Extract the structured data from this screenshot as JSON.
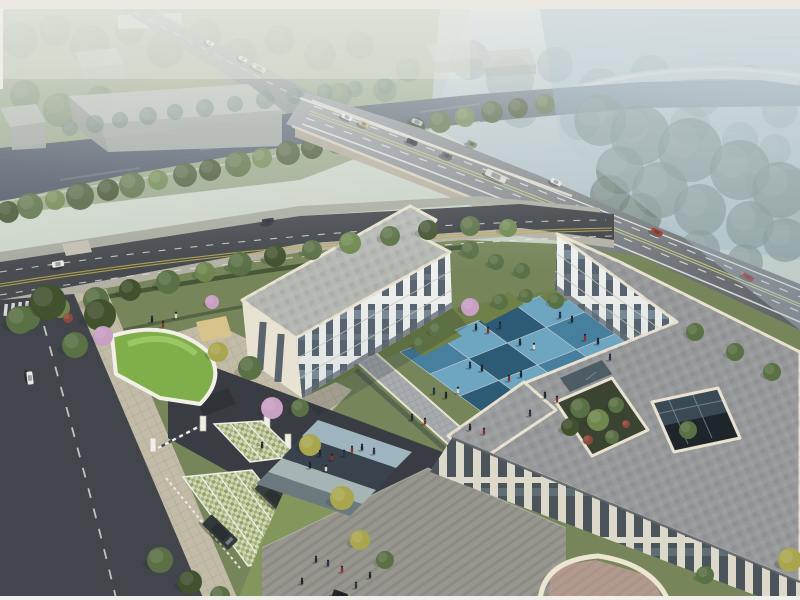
{
  "scene": {
    "type": "aerial-architectural-rendering"
  },
  "palette": {
    "river": "#51596a",
    "road_dark": "#42454b",
    "drive_dark": "#393c42",
    "ave_gray": "#8f9398",
    "lane_white": "#e9eae6",
    "lane_yellow": "#c2cc85",
    "bridge_fascia": "#b4ad9c",
    "parapet": "#e9e2d0",
    "facade_lit": "#edefec",
    "facade_warm": "#e7e2d1",
    "facade_shade": "#d8d4c5",
    "window_glass": "#3f4d5a",
    "roof_gray": "#97999b",
    "roof_left": "#b6b8b4",
    "court_light": "#6ea6c2",
    "court_mid": "#47809e",
    "court_dark": "#2d5a74",
    "grass_base": "#76865a",
    "grass_bright": "#83975c",
    "grass_court": "#6f8148",
    "green_roof": "#7fae4a",
    "stall": "#d2d6b8",
    "paver": "#c2bba7",
    "plaza": "#98978f",
    "terrace_pink": "#b29a8e",
    "warehouse_top": "#bcbfba",
    "warehouse_side": "#a7aba6",
    "sand": "#d8c38a",
    "band_light": "#9eb5bf",
    "band_dark": "#39434e",
    "band_pale": "#a7b4b4",
    "band_mid": "#6c7a80"
  },
  "courtyard": {
    "origin": [
      400,
      352
    ],
    "a": [
      38.75,
      -15.5
    ],
    "b": [
      30,
      22
    ],
    "rows": 4,
    "cols": 4,
    "tiles": [
      [
        "m",
        "l",
        "d",
        "l"
      ],
      [
        "l",
        "d",
        "l",
        "m"
      ],
      [
        "d",
        "l",
        "m",
        "l"
      ],
      [
        "l",
        "m",
        "l",
        "d"
      ]
    ],
    "grout": "#bfccd1"
  },
  "tree_type_colors": {
    "g": "#5a7045",
    "l": "#6f874f",
    "y": "#a9a64f",
    "d": "#42522f",
    "r": "#8a4a3c"
  },
  "trees": {
    "groups": [
      {
        "id": "trees-park-haze",
        "color": "#74846a",
        "opacity": 0.5,
        "shadow": false,
        "items": [
          [
            20,
            40,
            18
          ],
          [
            55,
            30,
            16
          ],
          [
            90,
            45,
            20
          ],
          [
            130,
            30,
            15
          ],
          [
            165,
            50,
            18
          ],
          [
            205,
            35,
            16
          ],
          [
            240,
            55,
            17
          ],
          [
            280,
            40,
            15
          ],
          [
            320,
            55,
            16
          ],
          [
            360,
            45,
            14
          ],
          [
            25,
            95,
            15
          ],
          [
            60,
            110,
            17
          ],
          [
            100,
            100,
            14
          ],
          [
            140,
            115,
            16
          ],
          [
            180,
            105,
            13
          ],
          [
            260,
            100,
            15
          ],
          [
            300,
            110,
            13
          ],
          [
            340,
            95,
            12
          ],
          [
            385,
            90,
            12
          ],
          [
            408,
            70,
            12
          ]
        ]
      },
      {
        "id": "trees-right-haze",
        "color": "#7e938d",
        "opacity": 0.4,
        "shadow": false,
        "items": [
          [
            470,
            60,
            20
          ],
          [
            510,
            80,
            24
          ],
          [
            555,
            65,
            18
          ],
          [
            600,
            90,
            22
          ],
          [
            650,
            75,
            20
          ],
          [
            700,
            95,
            22
          ],
          [
            750,
            85,
            20
          ],
          [
            780,
            110,
            18
          ],
          [
            520,
            110,
            18
          ],
          [
            580,
            120,
            20
          ],
          [
            630,
            120,
            18
          ],
          [
            690,
            125,
            20
          ],
          [
            740,
            140,
            18
          ],
          [
            775,
            150,
            16
          ]
        ]
      },
      {
        "id": "trees-river-north",
        "color": "#6e837c",
        "opacity": 0.55,
        "shadow": false,
        "items": [
          [
            70,
            128,
            8
          ],
          [
            95,
            124,
            9
          ],
          [
            120,
            120,
            8
          ],
          [
            148,
            116,
            9
          ],
          [
            175,
            112,
            8
          ],
          [
            205,
            108,
            9
          ],
          [
            235,
            104,
            8
          ],
          [
            265,
            100,
            9
          ],
          [
            295,
            96,
            8
          ],
          [
            325,
            92,
            8
          ],
          [
            355,
            89,
            8
          ],
          [
            385,
            86,
            8
          ]
        ]
      },
      {
        "id": "trees-right-mass",
        "color": "#667970",
        "opacity": 0.68,
        "shadow": false,
        "items": [
          [
            600,
            120,
            26
          ],
          [
            640,
            135,
            30
          ],
          [
            690,
            150,
            32
          ],
          [
            740,
            170,
            30
          ],
          [
            780,
            190,
            28
          ],
          [
            620,
            170,
            24
          ],
          [
            660,
            190,
            28
          ],
          [
            700,
            210,
            26
          ],
          [
            750,
            225,
            24
          ],
          [
            785,
            240,
            22
          ],
          [
            640,
            215,
            22
          ],
          [
            610,
            195,
            20
          ],
          [
            700,
            250,
            20
          ],
          [
            745,
            262,
            18
          ]
        ]
      },
      {
        "id": "trees-river-south",
        "cycle": [
          "#42522f",
          "#5a7045",
          "#6f874f",
          "#4c5e3a"
        ],
        "opacity": 0.95,
        "shadow": false,
        "items": [
          [
            8,
            212,
            11
          ],
          [
            30,
            206,
            13
          ],
          [
            55,
            200,
            10
          ],
          [
            80,
            196,
            14
          ],
          [
            108,
            190,
            11
          ],
          [
            132,
            185,
            13
          ],
          [
            158,
            180,
            10
          ],
          [
            185,
            175,
            12
          ],
          [
            210,
            170,
            11
          ],
          [
            238,
            164,
            13
          ],
          [
            262,
            158,
            10
          ],
          [
            288,
            153,
            12
          ],
          [
            312,
            148,
            11
          ],
          [
            338,
            142,
            12
          ],
          [
            362,
            137,
            10
          ],
          [
            390,
            131,
            12
          ],
          [
            415,
            127,
            10
          ],
          [
            440,
            122,
            11
          ],
          [
            465,
            117,
            10
          ],
          [
            492,
            112,
            11
          ],
          [
            518,
            108,
            10
          ],
          [
            545,
            104,
            10
          ]
        ]
      },
      {
        "id": "trees-belt",
        "typed": true,
        "opacity": 1,
        "shadow": true,
        "items": [
          [
            28,
            318,
            12,
            "g"
          ],
          [
            60,
            308,
            10,
            "l"
          ],
          [
            96,
            300,
            13,
            "g"
          ],
          [
            130,
            290,
            11,
            "d"
          ],
          [
            168,
            282,
            12,
            "g"
          ],
          [
            205,
            272,
            10,
            "l"
          ],
          [
            240,
            264,
            12,
            "g"
          ],
          [
            275,
            256,
            11,
            "d"
          ],
          [
            312,
            250,
            10,
            "g"
          ],
          [
            350,
            243,
            11,
            "l"
          ],
          [
            390,
            236,
            10,
            "g"
          ],
          [
            428,
            230,
            10,
            "d"
          ],
          [
            470,
            226,
            10,
            "g"
          ],
          [
            508,
            228,
            9,
            "l"
          ]
        ]
      },
      {
        "id": "trees-site",
        "typed": true,
        "opacity": 1,
        "shadow": true,
        "items": [
          [
            48,
            302,
            18,
            "d"
          ],
          [
            20,
            320,
            14,
            "g"
          ],
          [
            100,
            315,
            16,
            "d"
          ],
          [
            75,
            345,
            13,
            "g"
          ],
          [
            218,
            352,
            10,
            "y"
          ],
          [
            250,
            368,
            12,
            "g"
          ],
          [
            300,
            408,
            9,
            "g"
          ],
          [
            310,
            445,
            11,
            "y"
          ],
          [
            342,
            498,
            12,
            "y"
          ],
          [
            360,
            540,
            10,
            "y"
          ],
          [
            385,
            560,
            9,
            "g"
          ],
          [
            160,
            560,
            13,
            "g"
          ],
          [
            190,
            582,
            12,
            "d"
          ],
          [
            220,
            596,
            10,
            "g"
          ],
          [
            470,
            250,
            9,
            "g"
          ],
          [
            496,
            262,
            8,
            "g"
          ],
          [
            522,
            271,
            8,
            "g"
          ],
          [
            437,
            330,
            8,
            "g"
          ],
          [
            420,
            344,
            7,
            "g"
          ],
          [
            500,
            302,
            8,
            "g"
          ],
          [
            526,
            296,
            7,
            "g"
          ],
          [
            556,
            301,
            8,
            "g"
          ],
          [
            688,
            430,
            9,
            "g"
          ],
          [
            790,
            560,
            12,
            "y"
          ],
          [
            68,
            318,
            5,
            "r"
          ],
          [
            705,
            575,
            9,
            "g"
          ],
          [
            695,
            332,
            9,
            "g"
          ],
          [
            735,
            352,
            9,
            "g"
          ],
          [
            772,
            372,
            9,
            "g"
          ],
          [
            580,
            408,
            10,
            "g"
          ],
          [
            598,
            420,
            11,
            "l"
          ],
          [
            570,
            427,
            9,
            "d"
          ],
          [
            616,
            405,
            8,
            "g"
          ],
          [
            612,
            437,
            7,
            "g"
          ],
          [
            588,
            440,
            5,
            "r"
          ],
          [
            626,
            424,
            4,
            "r"
          ]
        ]
      },
      {
        "id": "trees-blossom",
        "color": "#c99fc4",
        "opacity": 1,
        "shadow": true,
        "items": [
          [
            103,
            336,
            10
          ],
          [
            272,
            408,
            11
          ],
          [
            470,
            307,
            9
          ],
          [
            212,
            302,
            7
          ]
        ]
      }
    ]
  },
  "vehicles": {
    "groups": [
      {
        "id": "cars-top-road",
        "items": [
          [
            210,
            43,
            27,
            "#eef0ee",
            8,
            4
          ],
          [
            243,
            59,
            27,
            "#eceeea",
            9,
            4
          ],
          [
            259,
            68,
            27,
            "#ded8c4",
            14,
            5
          ]
        ]
      },
      {
        "id": "cars-bridge",
        "items": [
          [
            347,
            117,
            24,
            "#e9eae7",
            11,
            5
          ],
          [
            364,
            124,
            24,
            "#c7b88a",
            10,
            5
          ],
          [
            417,
            122,
            22,
            "#aebfcb",
            11,
            5
          ],
          [
            412,
            142,
            22,
            "#2e3338",
            11,
            5
          ],
          [
            447,
            156,
            24,
            "#585e63",
            11,
            5
          ],
          [
            472,
            144,
            24,
            "#7d8262",
            10,
            5
          ],
          [
            496,
            176,
            25,
            "#dad7cf",
            22,
            7
          ],
          [
            556,
            182,
            25,
            "#e6e6e2",
            11,
            5
          ],
          [
            657,
            232,
            26,
            "#a23527",
            12,
            5
          ],
          [
            748,
            277,
            27,
            "#8e1f1c",
            12,
            5
          ]
        ]
      },
      {
        "id": "cars-street",
        "items": [
          [
            58,
            264,
            -10,
            "#e8e9e4",
            12,
            6
          ],
          [
            268,
            221,
            -8,
            "#2f343b",
            12,
            5
          ],
          [
            30,
            378,
            83,
            "#e8e9e6",
            13,
            6
          ],
          [
            340,
            595,
            20,
            "#23262a",
            15,
            7
          ]
        ]
      },
      {
        "id": "cars-parked",
        "suv": true,
        "items": [
          [
            274,
            497,
            44,
            "#3a3f3b",
            40,
            15
          ],
          [
            220,
            532,
            44,
            "#33383a",
            37,
            14
          ]
        ]
      }
    ]
  },
  "people_colors": [
    "#22272e",
    "#8c2f26",
    "#27374a",
    "#d8d4c9",
    "#3a4750",
    "#7a3348"
  ],
  "people": [
    [
      476,
      330,
      0
    ],
    [
      488,
      333,
      1
    ],
    [
      500,
      328,
      2
    ],
    [
      520,
      345,
      0
    ],
    [
      534,
      349,
      3
    ],
    [
      470,
      368,
      2
    ],
    [
      482,
      371,
      0
    ],
    [
      509,
      381,
      1
    ],
    [
      521,
      377,
      0
    ],
    [
      434,
      394,
      2
    ],
    [
      446,
      398,
      0
    ],
    [
      458,
      393,
      3
    ],
    [
      412,
      420,
      0
    ],
    [
      425,
      424,
      1
    ],
    [
      560,
      318,
      2
    ],
    [
      572,
      322,
      0
    ],
    [
      585,
      340,
      1
    ],
    [
      598,
      344,
      0
    ],
    [
      610,
      360,
      2
    ],
    [
      545,
      398,
      0
    ],
    [
      557,
      402,
      1
    ],
    [
      530,
      416,
      2
    ],
    [
      470,
      430,
      0
    ],
    [
      484,
      434,
      1
    ],
    [
      320,
      456,
      0
    ],
    [
      332,
      460,
      1
    ],
    [
      344,
      456,
      2
    ],
    [
      310,
      468,
      0
    ],
    [
      326,
      471,
      3
    ],
    [
      352,
      452,
      1
    ],
    [
      362,
      450,
      0
    ],
    [
      374,
      454,
      2
    ],
    [
      316,
      562,
      0
    ],
    [
      328,
      566,
      2
    ],
    [
      342,
      572,
      1
    ],
    [
      302,
      584,
      0
    ],
    [
      356,
      588,
      2
    ],
    [
      370,
      578,
      0
    ],
    [
      152,
      322,
      0
    ],
    [
      163,
      327,
      1
    ],
    [
      176,
      318,
      3
    ],
    [
      262,
      448,
      0
    ]
  ]
}
